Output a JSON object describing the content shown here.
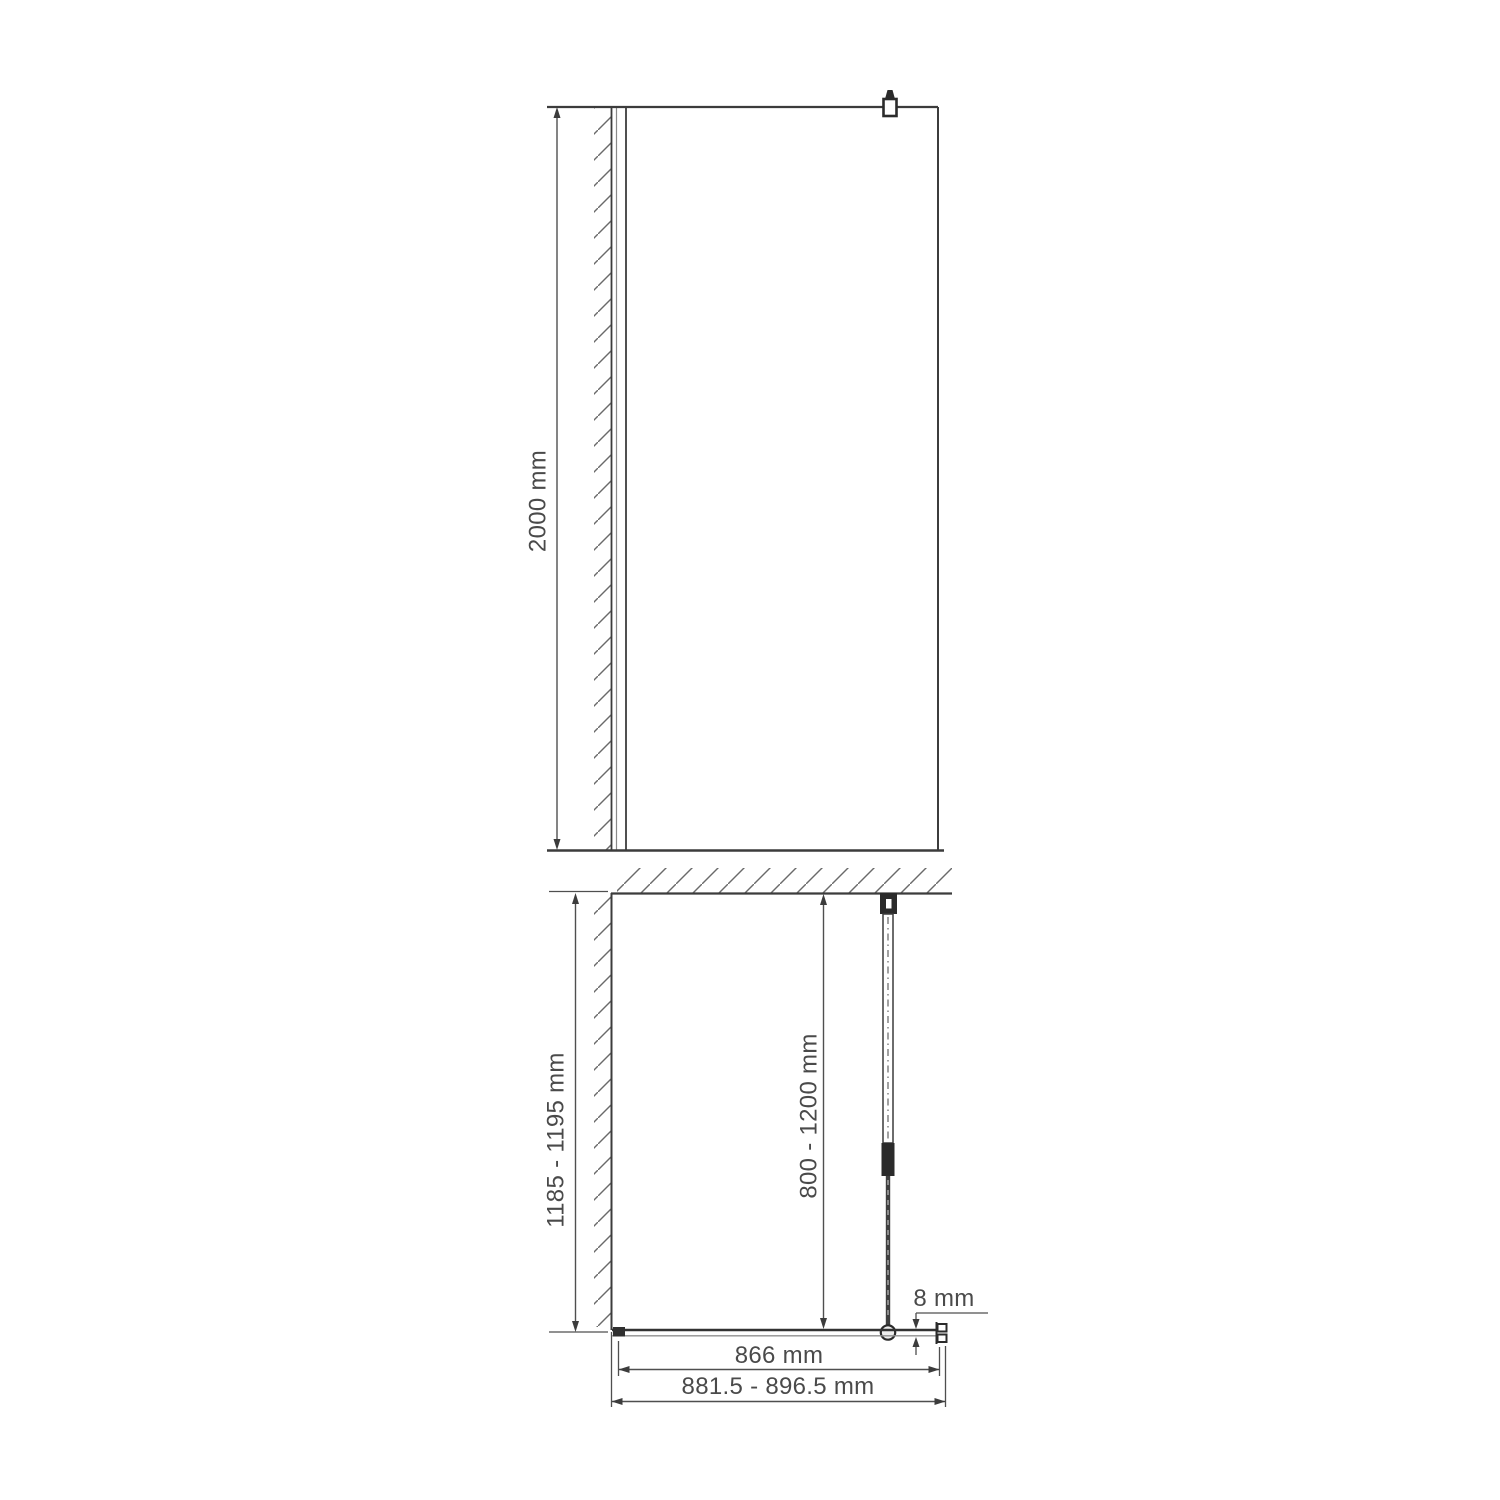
{
  "drawing": {
    "kind": "shower-glass-panel-technical-drawing",
    "dimensions": {
      "panel_height": "2000 mm",
      "side_depth": "1185 - 1195 mm",
      "support_bar_length": "800 - 1200 mm",
      "glass_thickness": "8 mm",
      "glass_width": "866 mm",
      "installation_width": "881.5 - 896.5 mm"
    },
    "colors": {
      "outline": "#3c3c3c",
      "dimension_line": "#4f4f4f",
      "hatch": "#6a6a6a",
      "fitting_fill": "#2b2b2b",
      "background": "#ffffff"
    }
  }
}
